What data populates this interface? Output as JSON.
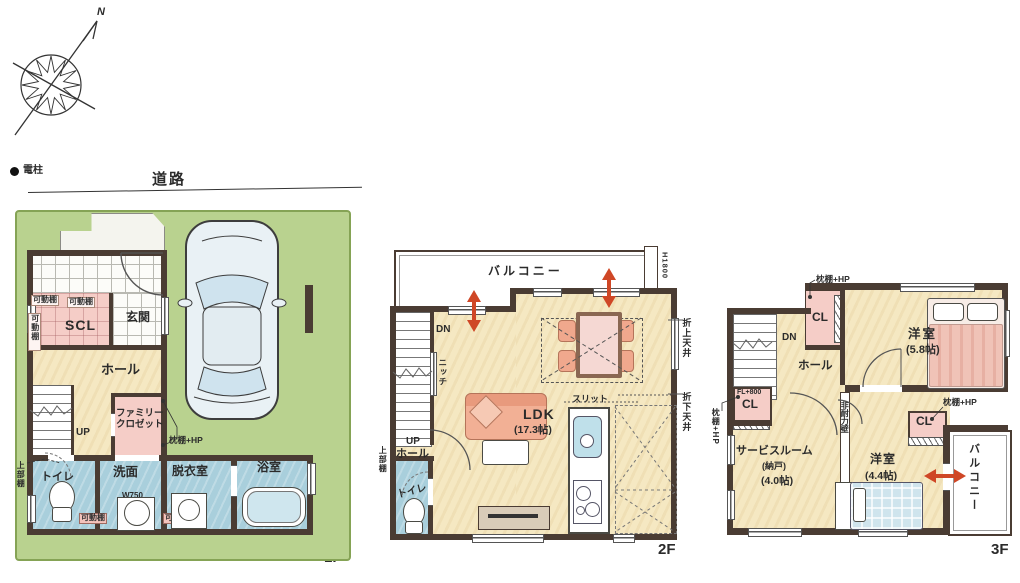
{
  "legend": {
    "power_pole": "電柱",
    "road": "道路",
    "north": "N"
  },
  "floor_labels": {
    "f1": "1F",
    "f2": "2F",
    "f3": "3F"
  },
  "terms": {
    "kadodana": "可動棚",
    "jobudana": "上部棚",
    "makurahp": "枕棚+HP",
    "hall": "ホール",
    "toilet": "トイレ",
    "up": "UP",
    "dn": "DN",
    "cl": "CL",
    "balcony": "バルコニー",
    "yoshitsu": "洋室"
  },
  "f1": {
    "scl": "SCL",
    "genkan": "玄関",
    "family_closet_line1": "ファミリー",
    "family_closet_line2": "クロゼット",
    "senmen": "洗面",
    "w750": "W750",
    "datsuishitsu": "脱衣室",
    "yokushitsu": "浴室"
  },
  "f2": {
    "h1800": "H1800",
    "niche": "ニッチ",
    "ldk": "LDK",
    "ldk_size": "(17.3帖)",
    "slit": "スリット",
    "oriage": "折上天井",
    "orisage": "折下天井"
  },
  "f3": {
    "fl800": "FL+800",
    "room1_size": "(5.8帖)",
    "service": "サービスルーム",
    "service_alt": "(納戸)",
    "service_size": "(4.0帖)",
    "wall_note": "非耐力壁",
    "room2_size": "(4.4帖)"
  },
  "palette": {
    "wall": "#4a3c33",
    "lot_green": "#b9d28f",
    "floor_cream": "#f5e8c2",
    "wet_blue": "#a9cfdc",
    "closet_pink": "#f5cdc7",
    "furniture_salmon": "#f0a88d",
    "arrow_red": "#cf4726"
  }
}
